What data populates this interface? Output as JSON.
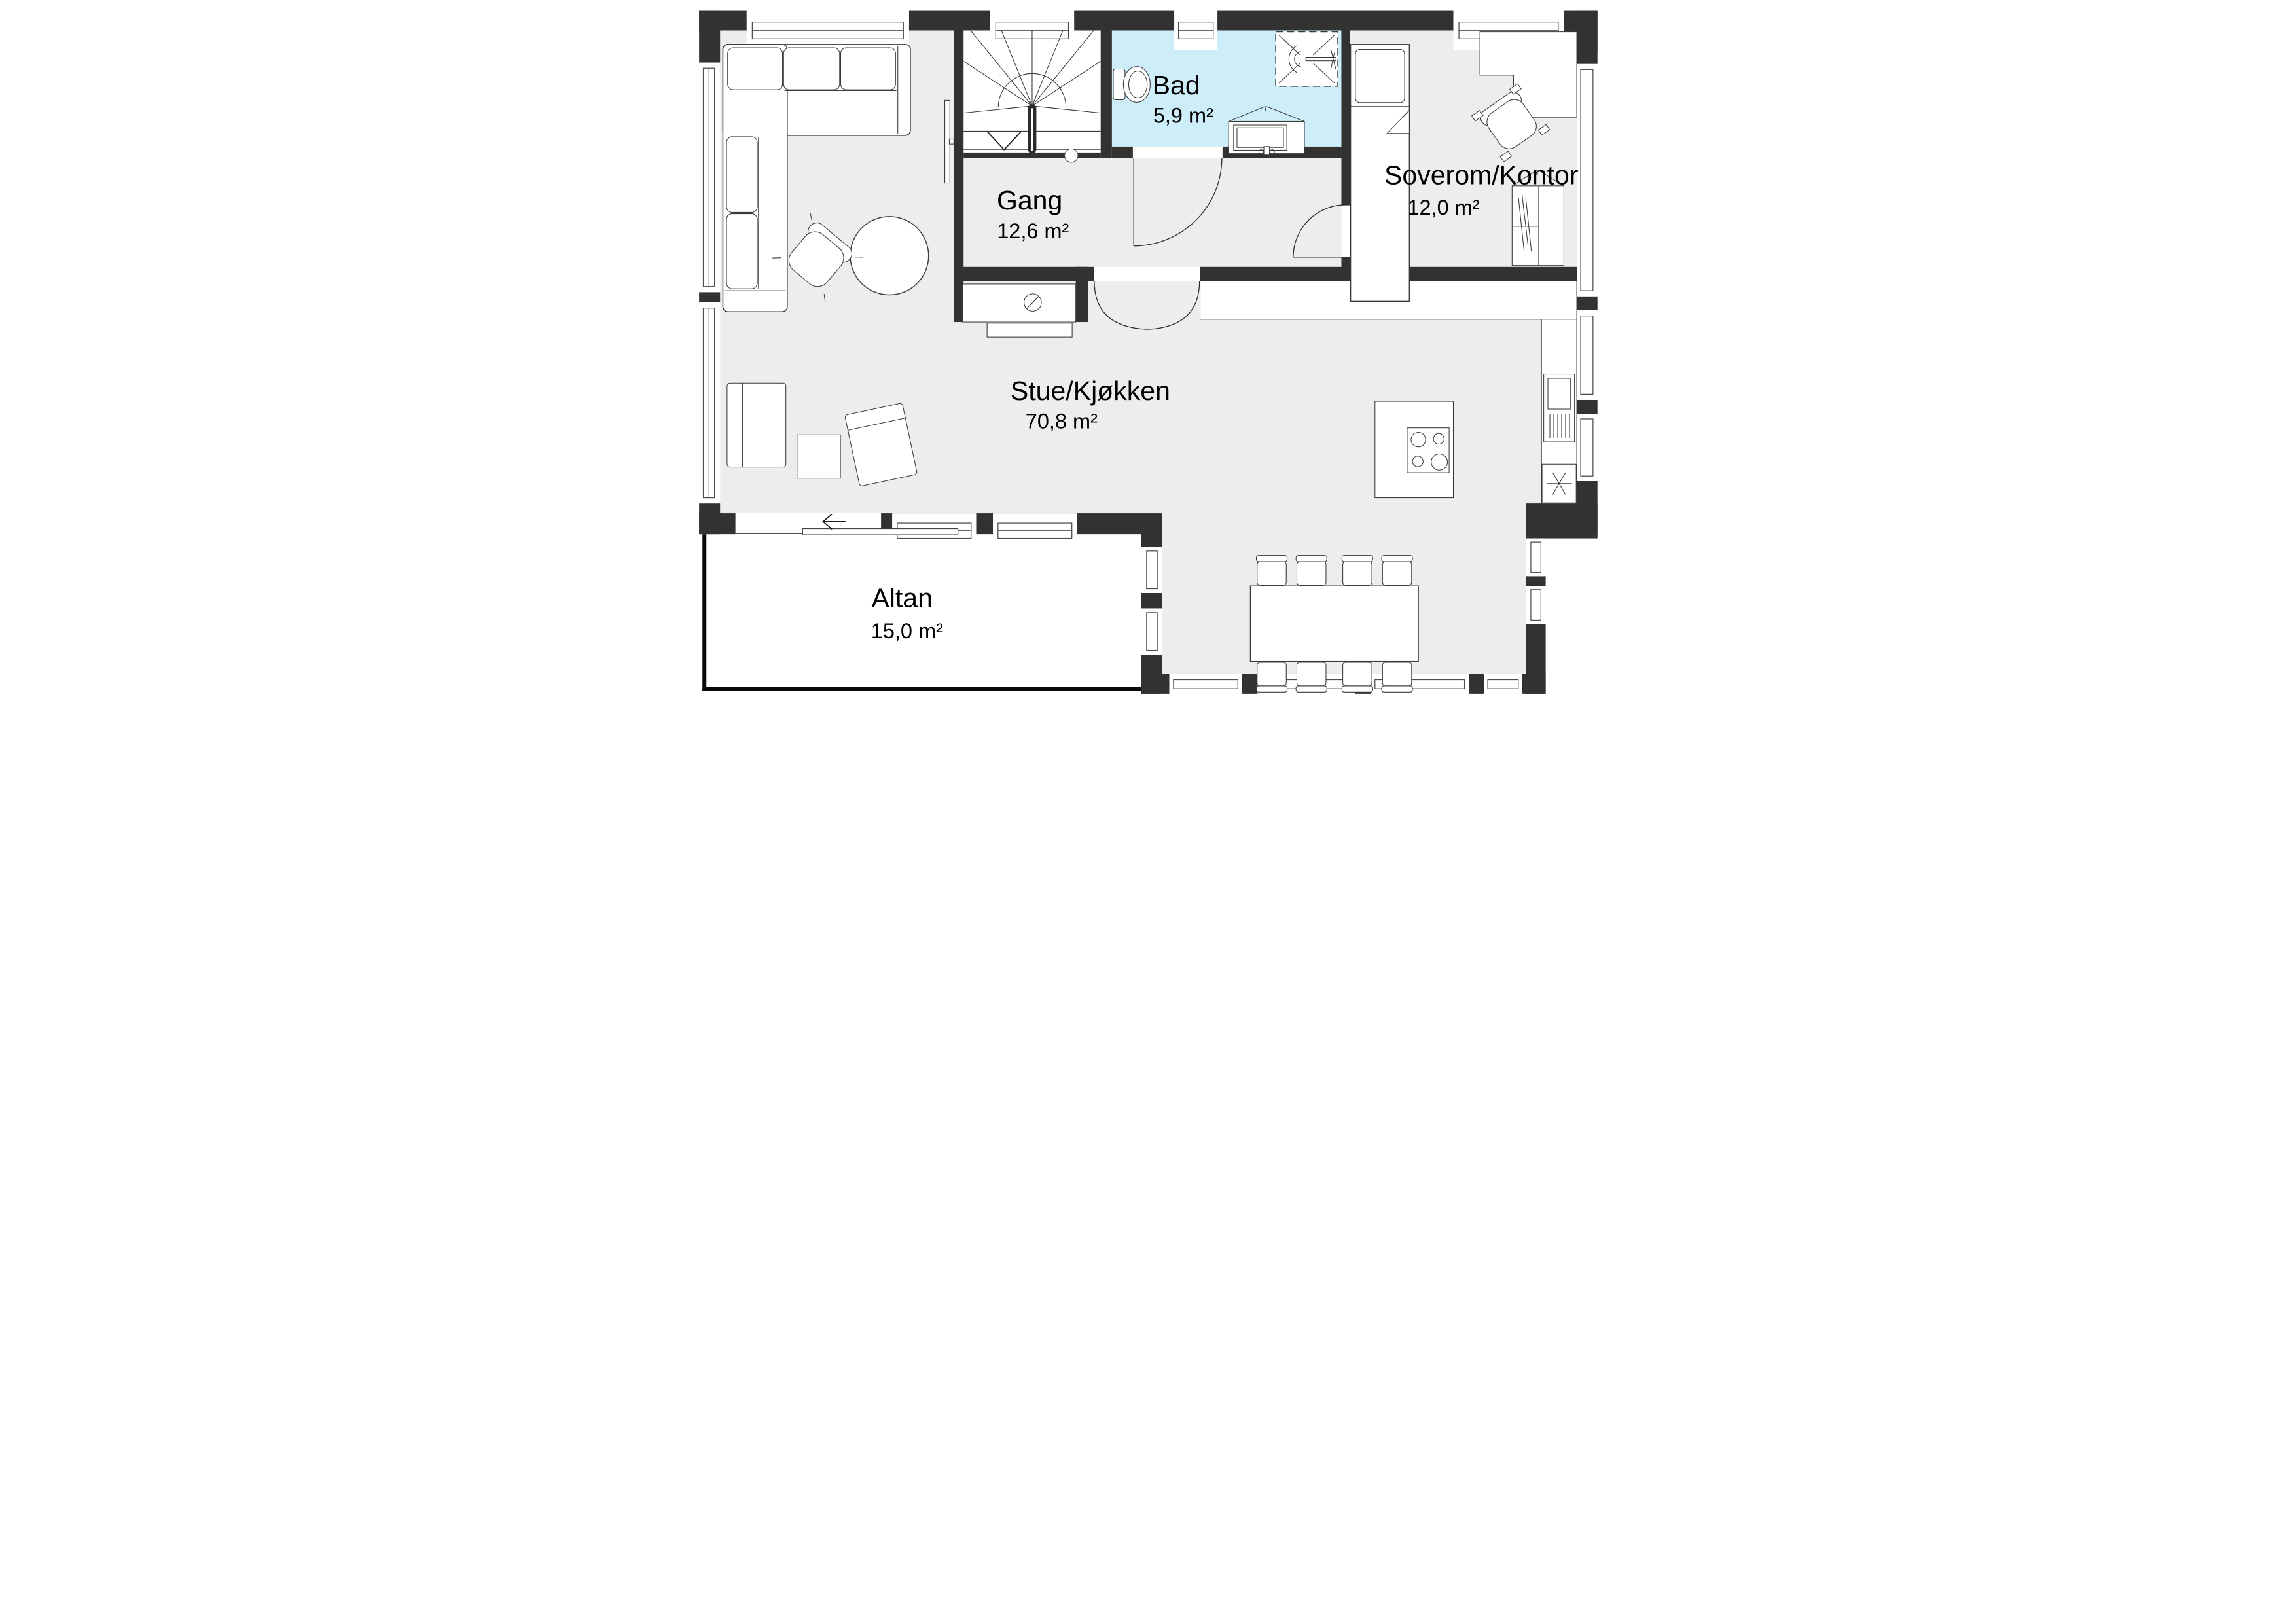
{
  "plan": {
    "rooms": {
      "stue": {
        "name": "Stue/Kjøkken",
        "area": "70,8 m²"
      },
      "gang": {
        "name": "Gang",
        "area": "12,6 m²"
      },
      "bad": {
        "name": "Bad",
        "area": "5,9 m²"
      },
      "soverom": {
        "name": "Soverom/Kontor",
        "area": "12,0 m²"
      },
      "altan": {
        "name": "Altan",
        "area": "15,0 m²"
      }
    },
    "colors": {
      "wall": "#323232",
      "floor": "#ededed",
      "bath": "#cdeef8",
      "outdoor": "#ffffff"
    }
  }
}
